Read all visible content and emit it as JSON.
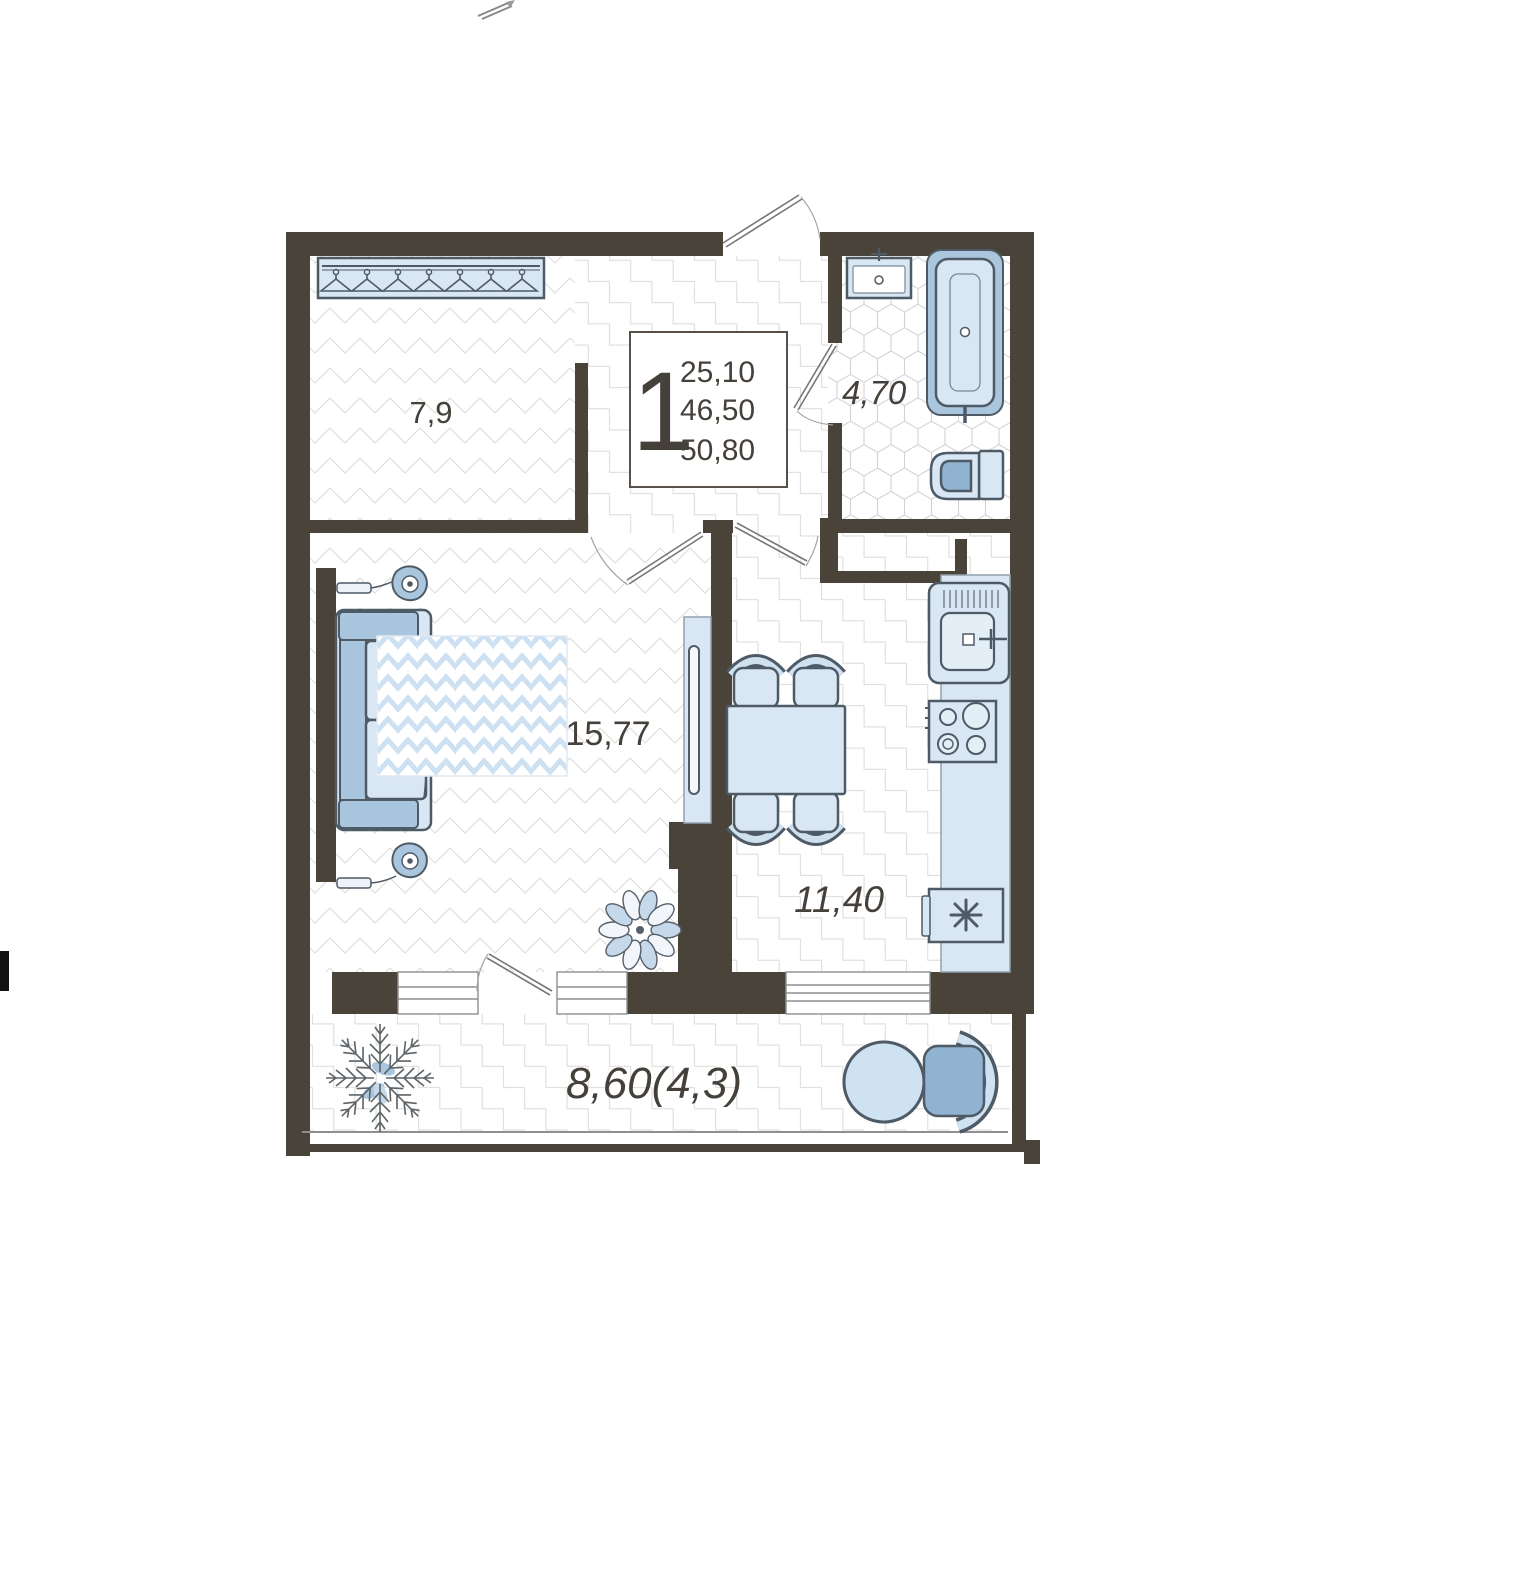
{
  "plan": {
    "legend": {
      "rooms_count": "1",
      "areas": [
        "25,10",
        "46,50",
        "50,80"
      ]
    },
    "rooms": {
      "wardrobe": {
        "area": "7,9"
      },
      "bathroom": {
        "area": "4,70"
      },
      "living": {
        "area": "15,77"
      },
      "kitchen": {
        "area": "11,40"
      },
      "balcony": {
        "area": "8,60(4,3)"
      }
    },
    "colors": {
      "wall": "#4a4339",
      "outline": "#4e5a66",
      "light": "#d9e7f4",
      "mid": "#aac6de",
      "deep": "#8fb3d1",
      "floorline": "#dcdcdc",
      "hexline": "#cfd3d6",
      "carpet": "#cde1f2"
    }
  }
}
